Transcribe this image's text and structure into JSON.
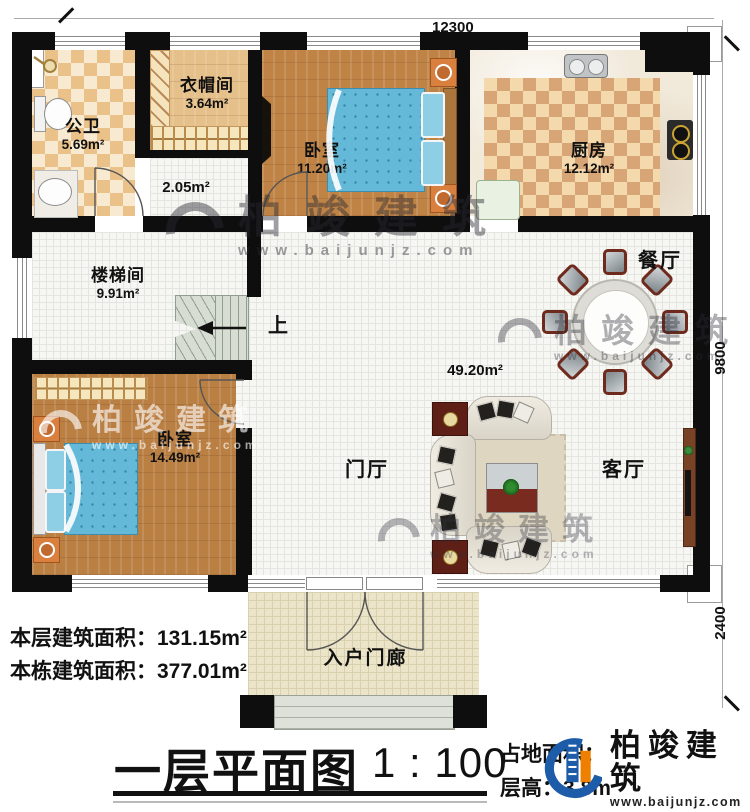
{
  "plan": {
    "title": "一层平面图",
    "scale": "1 : 100",
    "dims": {
      "width_top": "12300",
      "height_right": "9800",
      "porch_right": "2400"
    },
    "rooms": {
      "bathroom": {
        "name": "公卫",
        "area": "5.69m²"
      },
      "cloakroom": {
        "name": "衣帽间",
        "area": "3.64m²"
      },
      "hallway": {
        "area": "2.05m²"
      },
      "bedroom_top": {
        "name": "卧室",
        "area": "11.20m²"
      },
      "kitchen": {
        "name": "厨房",
        "area": "12.12m²"
      },
      "stairwell": {
        "name": "楼梯间",
        "area": "9.91m²"
      },
      "bedroom_left": {
        "name": "卧室",
        "area": "14.49m²"
      },
      "foyer": {
        "name": "门厅"
      },
      "living": {
        "name": "客厅"
      },
      "dining": {
        "name": "餐厅"
      },
      "hall_area": {
        "area": "49.20m²"
      },
      "porch": {
        "name": "入户门廊"
      }
    },
    "stairs_up": "上",
    "areas": {
      "floor_label": "本层建筑面积：",
      "floor_value": "131.15m²",
      "building_label": "本栋建筑面积：",
      "building_value": "377.01m²",
      "site_label": "占地面积：",
      "height_label": "层高：",
      "height_value": "3.8m"
    },
    "branding": {
      "name": "柏竣建筑",
      "url": "www.baijunjz.com"
    },
    "colors": {
      "wall": "#0e0e0e",
      "wood": "#bf8345",
      "bed_blue": "#64b9d8",
      "brand_blue": "#1d5ca8",
      "brand_orange": "#ef7f00"
    }
  }
}
